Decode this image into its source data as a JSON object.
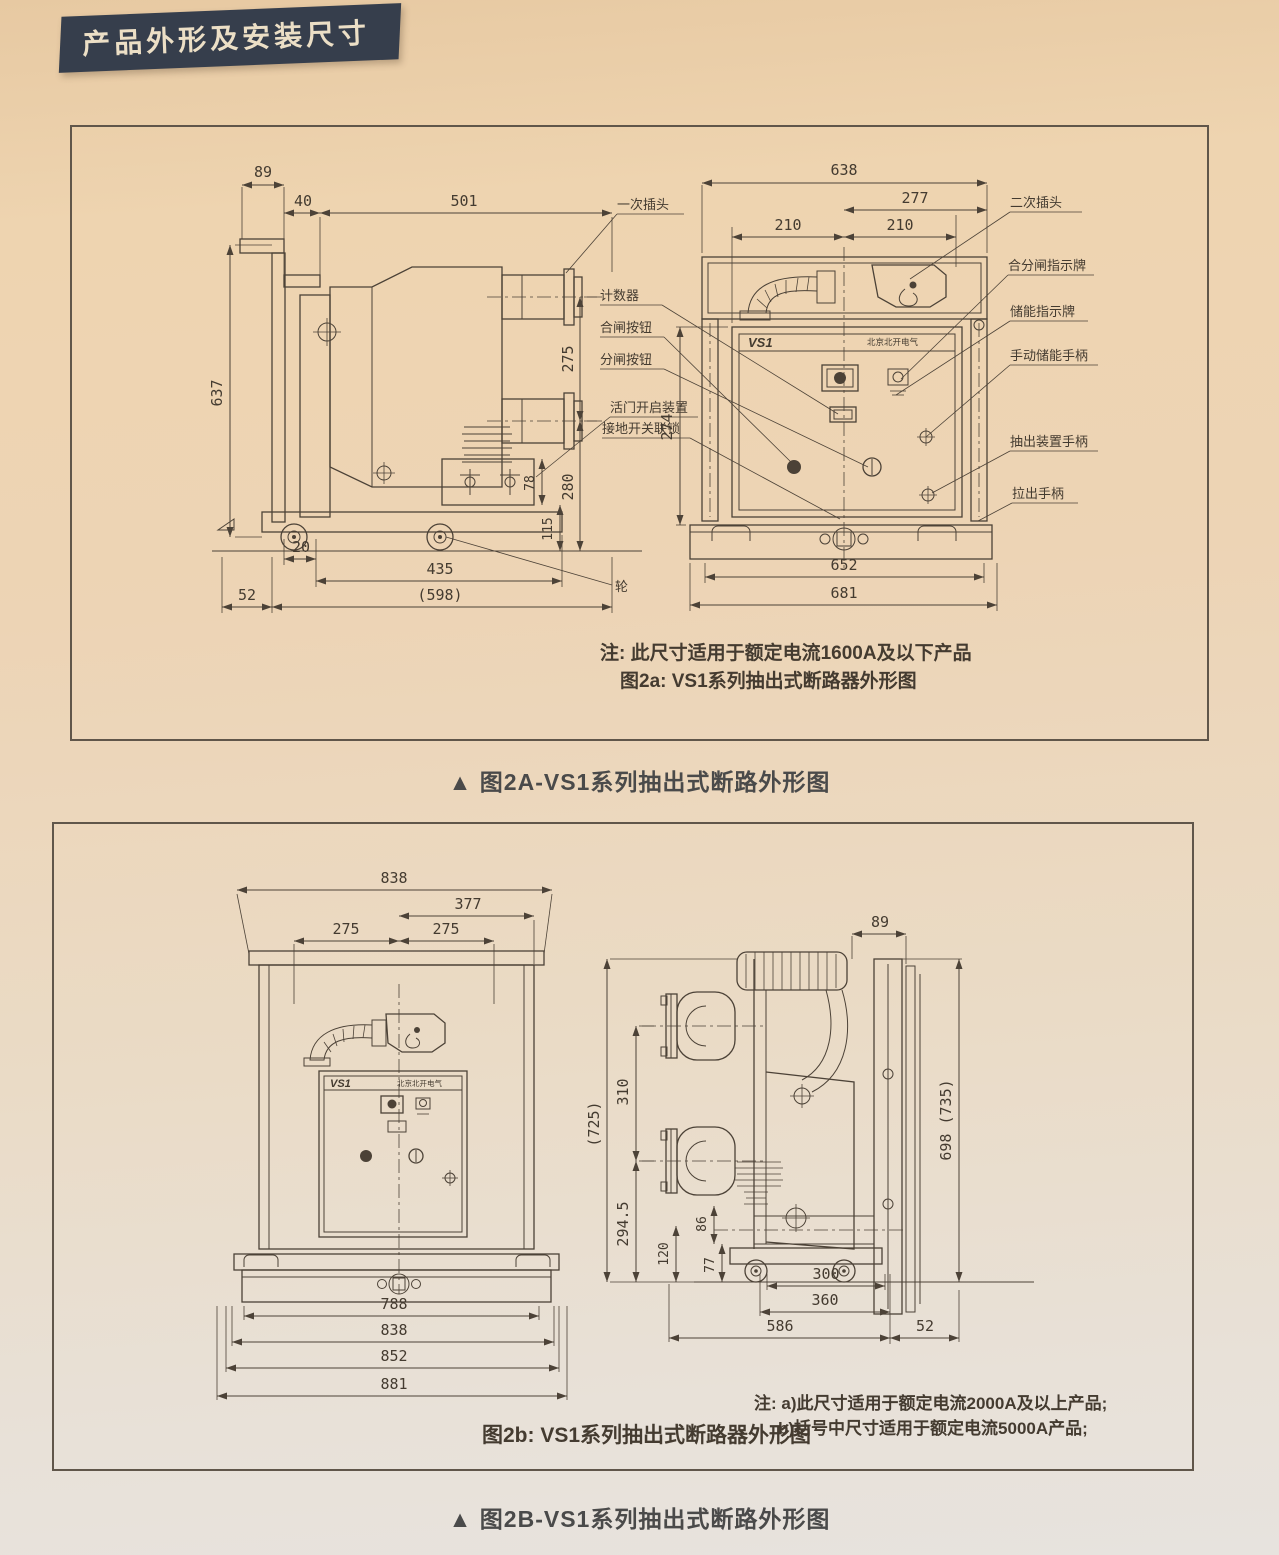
{
  "page": {
    "title": "产品外形及安装尺寸",
    "caption_2a": "▲ 图2A-VS1系列抽出式断路外形图",
    "caption_2b": "▲ 图2B-VS1系列抽出式断路外形图"
  },
  "colors": {
    "paper": "#ecd2ae",
    "ink": "#4c4237",
    "banner_bg": "#363e4c",
    "banner_text": "#ecdfc6"
  },
  "fig2a": {
    "note1": "注: 此尺寸适用于额定电流1600A及以下产品",
    "note2": "图2a: VS1系列抽出式断路器外形图",
    "panel_logo": "VS1",
    "panel_brand": "北京北开电气",
    "wheel_label": "轮",
    "labels_left": [
      "一次插头",
      "计数器",
      "合闸按钮",
      "分闸按钮",
      "活门开启装置",
      "接地开关联锁"
    ],
    "labels_right": [
      "二次插头",
      "合分闸指示牌",
      "储能指示牌",
      "手动储能手柄",
      "抽出装置手柄",
      "拉出手柄"
    ],
    "dims_side": {
      "w89": "89",
      "w40": "40",
      "w501": "501",
      "h637": "637",
      "h275": "275",
      "h280": "280",
      "h78": "78",
      "h115": "115",
      "w20": "20",
      "w435": "435",
      "w598": "(598)",
      "w52": "52"
    },
    "dims_front": {
      "w638": "638",
      "w277": "277",
      "w210l": "210",
      "w210r": "210",
      "h274": "274",
      "w652": "652",
      "w681": "681"
    }
  },
  "fig2b": {
    "note1": "注: a)此尺寸适用于额定电流2000A及以上产品;",
    "note2": "b)括号中尺寸适用于额定电流5000A产品;",
    "caption": "图2b: VS1系列抽出式断路器外形图",
    "panel_logo": "VS1",
    "panel_brand": "北京北开电气",
    "dims_front": {
      "w838t": "838",
      "w377": "377",
      "w275l": "275",
      "w275r": "275",
      "w788": "788",
      "w838b": "838",
      "w852": "852",
      "w881": "881"
    },
    "dims_side": {
      "w89": "89",
      "h725": "(725)",
      "h310": "310",
      "h2945": "294.5",
      "h86": "86",
      "h120": "120",
      "h77": "77",
      "h698": "698 (735)",
      "w300": "300",
      "w360": "360",
      "w586": "586",
      "w52": "52"
    }
  }
}
